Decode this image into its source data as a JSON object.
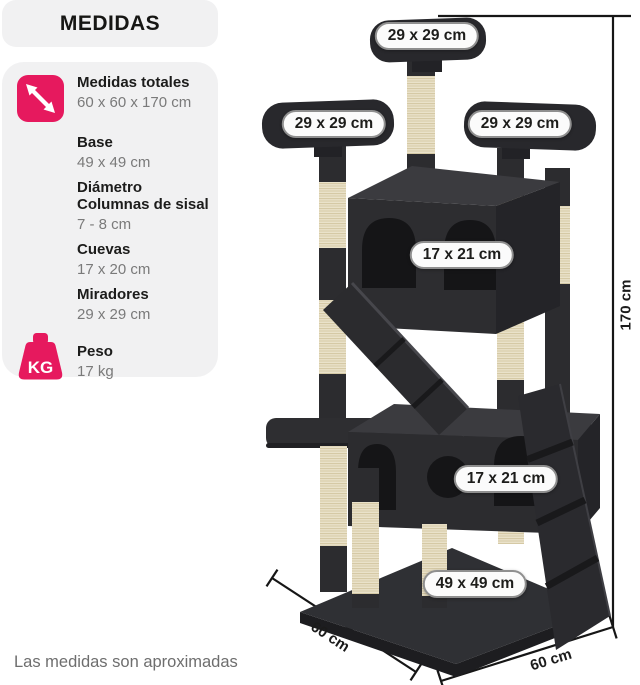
{
  "title": "MEDIDAS",
  "specs": {
    "items": [
      {
        "icon": "expand-arrows-icon",
        "label": "Medidas totales",
        "value": "60 x 60 x 170 cm"
      },
      {
        "label": "Base",
        "value": "49 x 49 cm"
      },
      {
        "label": "Diámetro Columnas de sisal",
        "value": "7 - 8 cm"
      },
      {
        "label": "Cuevas",
        "value": "17 x 20 cm"
      },
      {
        "label": "Miradores",
        "value": "29 x 29 cm"
      },
      {
        "icon": "weight-kg-icon",
        "icon_text": "KG",
        "label": "Peso",
        "value": "17 kg"
      }
    ]
  },
  "diagram": {
    "platform_top_label": "29 x 29 cm",
    "platform_left_label": "29 x 29 cm",
    "platform_right_label": "29 x 29 cm",
    "upper_cave_label": "17 x 21 cm",
    "lower_cave_label": "17 x 21 cm",
    "base_label": "49 x 49 cm",
    "height_label": "170 cm",
    "depth_label": "60 cm",
    "width_label": "60 cm"
  },
  "footnote": "Las medidas son aproximadas",
  "colors": {
    "accent": "#e6195e",
    "panel": "#f1f1f2",
    "plush_dark": "#2c2c2f",
    "sisal": "#eae2ca",
    "text_primary": "#1c1c1b",
    "text_secondary": "#7a7a7a"
  }
}
